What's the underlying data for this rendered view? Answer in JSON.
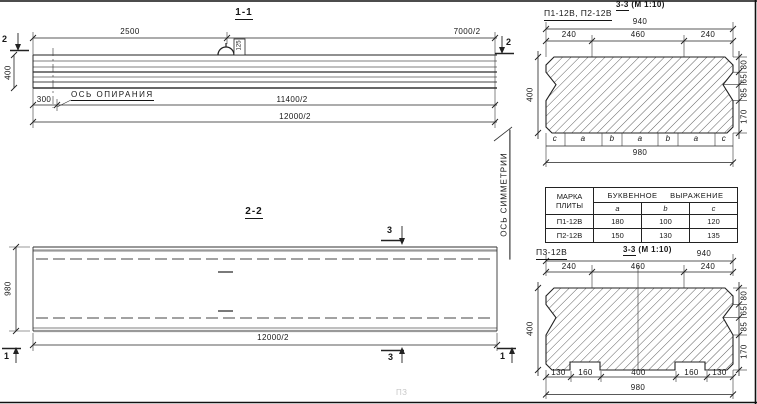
{
  "view11": {
    "title": "1-1",
    "dim_2500": "2500",
    "dim_7000": "7000/2",
    "dim_300": "300",
    "dim_11400": "11400/2",
    "dim_12000": "12000/2",
    "dim_400": "400",
    "loop_label": "125",
    "support_axis": "ОСЬ ОПИРАНИЯ",
    "cut_left": "2",
    "cut_right": "2"
  },
  "view22": {
    "title": "2-2",
    "dim_980": "980",
    "dim_12000": "12000/2",
    "symmetry_axis": "ОСЬ СИММЕТРИИ",
    "cut3": "3",
    "cut1": "1"
  },
  "sec_top": {
    "plates": "П1-12В, П2-12В",
    "title": "3-3",
    "scale": "(М 1:10)",
    "dim_940": "940",
    "dim_240l": "240",
    "dim_460": "460",
    "dim_240r": "240",
    "dim_400": "400",
    "dim_980": "980",
    "right_dims": [
      "80",
      "65",
      "85",
      "170"
    ],
    "letters": [
      "c",
      "a",
      "b",
      "a",
      "b",
      "a",
      "c"
    ]
  },
  "table": {
    "h_mark_1": "МАРКА",
    "h_mark_2": "ПЛИТЫ",
    "h_expr": "БУКВЕННОЕ ВЫРАЖЕНИЕ",
    "cols": [
      "a",
      "b",
      "c"
    ],
    "rows": [
      {
        "mark": "П1-12В",
        "a": "180",
        "b": "100",
        "c": "120"
      },
      {
        "mark": "П2-12В",
        "a": "150",
        "b": "130",
        "c": "135"
      }
    ]
  },
  "sec_bottom": {
    "plate": "П3-12В",
    "title": "3-3",
    "scale": "(М 1:10)",
    "dim_940": "940",
    "dim_240l": "240",
    "dim_460": "460",
    "dim_240r": "240",
    "dim_400": "400",
    "dim_980": "980",
    "right_dims": [
      "80",
      "65",
      "85",
      "170"
    ],
    "bottom_dims": [
      "130",
      "160",
      "400",
      "160",
      "130"
    ]
  },
  "artifact": {
    "faint": "ПЗ"
  }
}
